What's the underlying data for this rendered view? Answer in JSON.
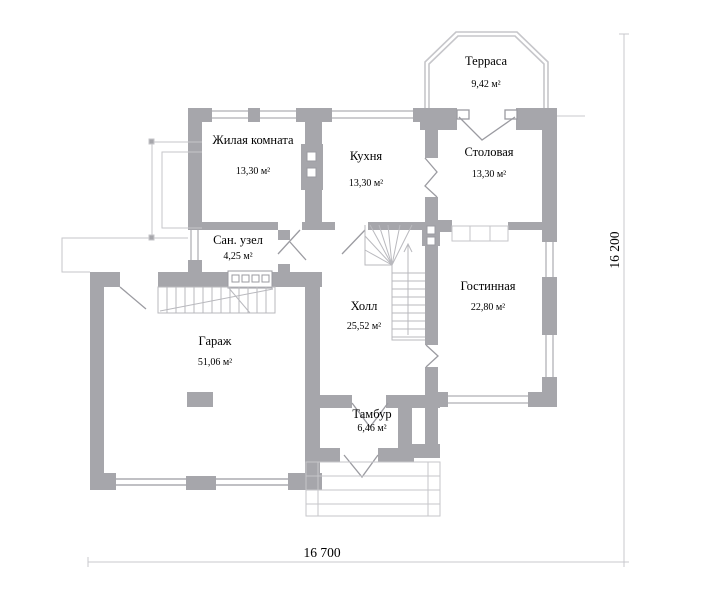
{
  "plan": {
    "title": "floor-plan-first-floor",
    "rooms": [
      {
        "id": "terrace",
        "name": "Терраса",
        "area": "9,42 м²"
      },
      {
        "id": "living-room",
        "name": "Жилая комната",
        "area": "13,30 м²"
      },
      {
        "id": "kitchen",
        "name": "Кухня",
        "area": "13,30 м²"
      },
      {
        "id": "dining-room",
        "name": "Столовая",
        "area": "13,30 м²"
      },
      {
        "id": "bathroom",
        "name": "Сан. узел",
        "area": "4,25 м²"
      },
      {
        "id": "hall",
        "name": "Холл",
        "area": "25,52 м²"
      },
      {
        "id": "lounge",
        "name": "Гостинная",
        "area": "22,80 м²"
      },
      {
        "id": "garage",
        "name": "Гараж",
        "area": "51,06 м²"
      },
      {
        "id": "vestibule",
        "name": "Тамбур",
        "area": "6,46 м²"
      }
    ],
    "dimensions": {
      "bottom": "16 700",
      "right": "16 200"
    },
    "colors": {
      "wall": "#a6a6ab",
      "line": "#c6c6ca",
      "stair": "#b9b9be",
      "door": "#9b9ba1",
      "dim": "#c9c9cd",
      "text": "#000000",
      "background": "#ffffff"
    }
  }
}
